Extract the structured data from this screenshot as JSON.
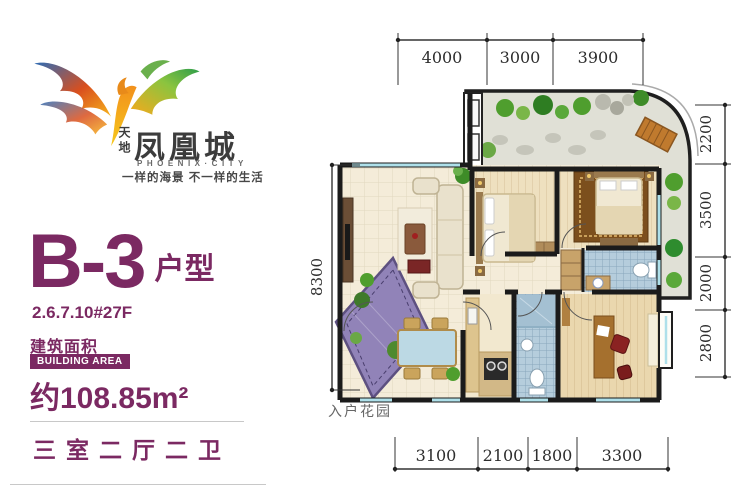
{
  "brand": {
    "prefix": "天地",
    "name_cn": "凤凰城",
    "name_en": "PHOENIX·CITY",
    "tagline": "一样的海景 不一样的生活"
  },
  "unit": {
    "name": "B-3",
    "type_label": "户型",
    "buildings": "2.6.7.10#27F",
    "area_label_cn": "建筑面积",
    "area_label_en": "BUILDING AREA",
    "area_value": "约108.85m²",
    "layout": "三室二厅二卫"
  },
  "plan": {
    "entrance_garden_label": "入户花园",
    "dims": {
      "top": [
        "4000",
        "3000",
        "3900"
      ],
      "right": [
        "2200",
        "3500",
        "2000",
        "2800"
      ],
      "bottom": [
        "3100",
        "2100",
        "1800",
        "3300"
      ],
      "left": [
        "8300"
      ]
    }
  },
  "colors": {
    "accent_purple": "#7b2962",
    "wall_black": "#1b1b1b",
    "floor_cream": "#f4ecd9",
    "bedroom_floor": "#eee0bf",
    "tile_blue": "#b5cddc",
    "entrance_garden_purple": "#9183b8",
    "garden_gray": "#e0e0d6",
    "window_cyan": "#aee0ea"
  }
}
